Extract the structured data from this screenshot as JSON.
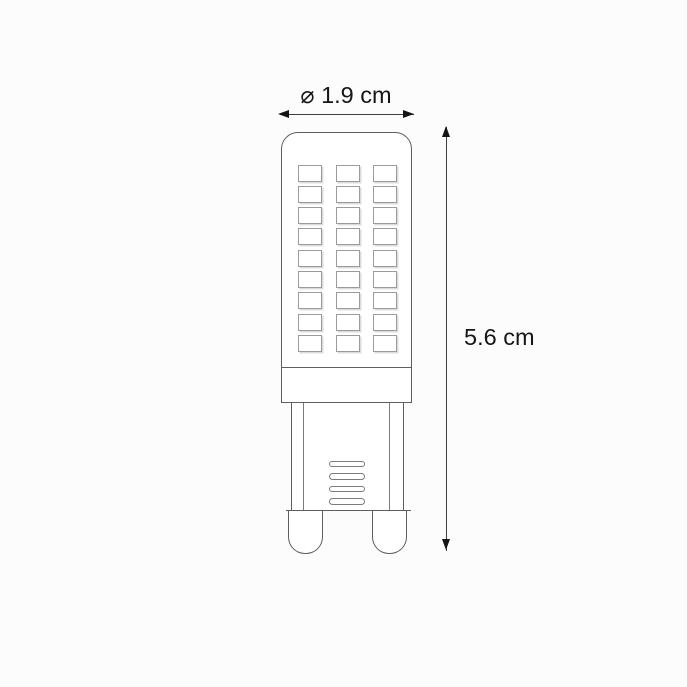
{
  "page": {
    "background": "#fcfcfc"
  },
  "diagram": {
    "dimensions": {
      "diameter_label": "⌀ 1.9 cm",
      "height_label": "5.6 cm"
    },
    "bulb": {
      "led_rows": 9,
      "led_cols": 3,
      "vent_slots": 4,
      "pin_count": 2
    },
    "colors": {
      "outline": "#5e5e5e",
      "outline_light": "#7b7b7b",
      "chip_border": "#9b9b9b",
      "chip_shadow": "#dcdcdc",
      "dimension_line": "#3f3f3f",
      "arrow": "#141414",
      "text": "#161616",
      "fill": "#ffffff"
    }
  }
}
